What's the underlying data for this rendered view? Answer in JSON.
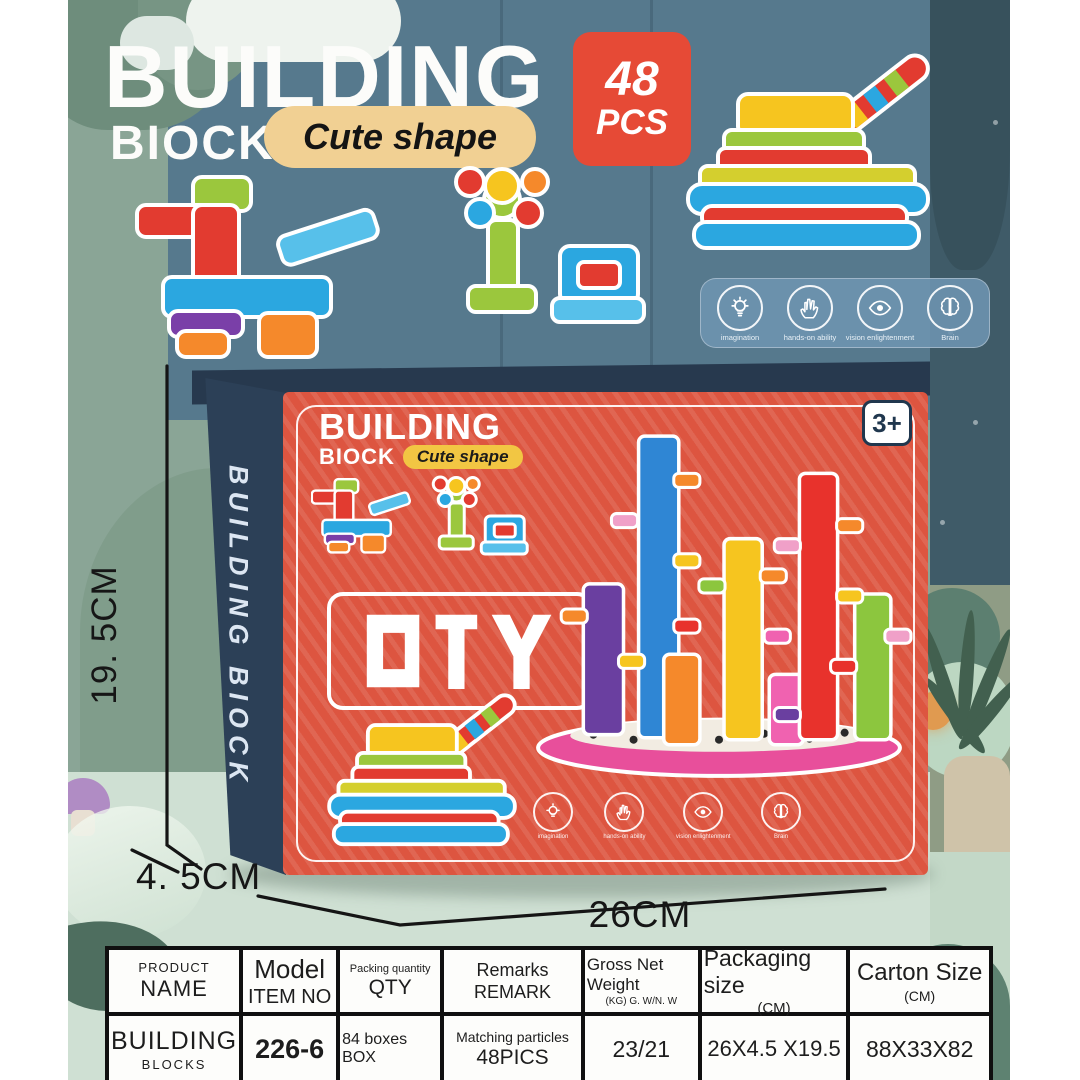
{
  "header": {
    "title_line1": "BUILDING",
    "title_line2": "BIOCK",
    "subtitle": "Cute shape",
    "count": {
      "number": "48",
      "unit": "PCS"
    }
  },
  "features": [
    {
      "icon": "lightbulb-icon",
      "label": "imagination"
    },
    {
      "icon": "hand-icon",
      "label": "hands-on ability"
    },
    {
      "icon": "eye-icon",
      "label": "vision enlightenment"
    },
    {
      "icon": "brain-icon",
      "label": "Brain"
    }
  ],
  "box": {
    "side_text": "BUILDING BIOCK",
    "title_line1": "BUILDING",
    "title_line2": "BIOCK",
    "subtitle": "Cute shape",
    "age_badge": "3+",
    "diy_label": "DIY"
  },
  "dimensions": {
    "height": "19. 5CM",
    "depth": "4. 5CM",
    "width": "26CM"
  },
  "spec_table": {
    "headers": [
      {
        "line1": "PRODUCT",
        "line2": "NAME"
      },
      {
        "line1": "Model",
        "line2": "ITEM NO"
      },
      {
        "line1": "Packing quantity",
        "line2": "QTY"
      },
      {
        "line1": "Remarks",
        "line2": "REMARK"
      },
      {
        "line1": "Gross Net Weight",
        "line2": "(KG) G. W/N. W"
      },
      {
        "line1": "Packaging size",
        "line2": "(CM)"
      },
      {
        "line1": "Carton Size",
        "line2": "(CM)"
      }
    ],
    "row": [
      {
        "line1": "BUILDING",
        "line2": "BLOCKS"
      },
      {
        "line1": "226-6",
        "line2": ""
      },
      {
        "line1": "84 boxes BOX",
        "line2": ""
      },
      {
        "line1": "Matching particles",
        "line2": "48PICS"
      },
      {
        "line1": "23/21",
        "line2": ""
      },
      {
        "line1": "26X4.5 X19.5",
        "line2": ""
      },
      {
        "line1": "88X33X82",
        "line2": ""
      }
    ]
  },
  "colors": {
    "accent_red": "#e64a36",
    "box_orange": "#dd5540",
    "box_navy": "#2c4057",
    "wall_blue": "#56798d",
    "bg_sage": "#8aa596",
    "floor_mint": "#cfe0d3",
    "banner_blue": "#6e94b1",
    "pill_cream": "#f1d093",
    "pill_gold": "#f2c643"
  }
}
